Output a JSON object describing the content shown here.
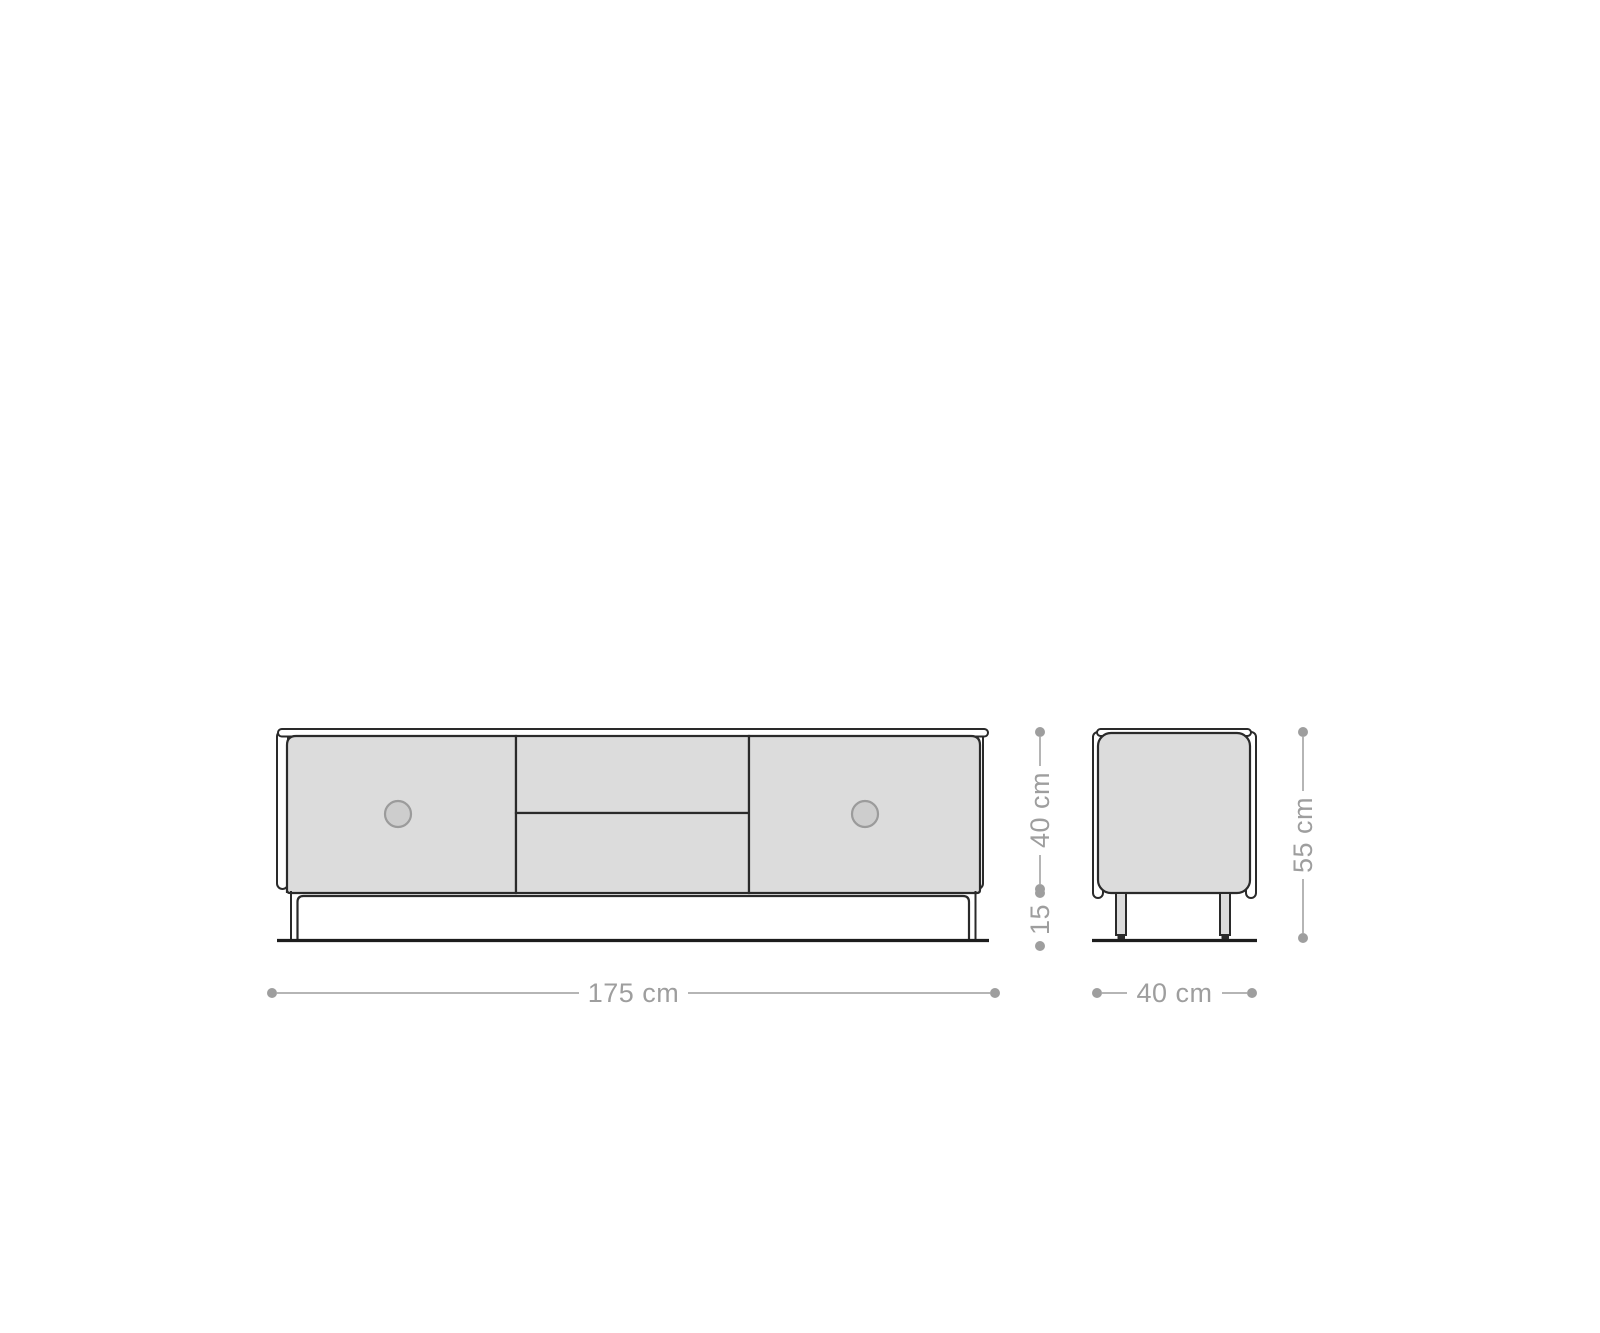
{
  "diagram_type": "furniture-dimension-drawing",
  "dimensions": {
    "front_width": "175 cm",
    "side_depth": "40 cm",
    "body_height": "40 cm",
    "leg_height": "15",
    "total_height": "55 cm"
  },
  "colors": {
    "panel_fill": "#dcdcdc",
    "knob_fill": "#cdcdcd",
    "knob_stroke": "#9b9b9b",
    "outline": "#2a2a2a",
    "ground": "#1d1d1d",
    "dimension_line": "#b5b5b5",
    "dimension_text": "#9e9e9e",
    "background": "#ffffff"
  }
}
